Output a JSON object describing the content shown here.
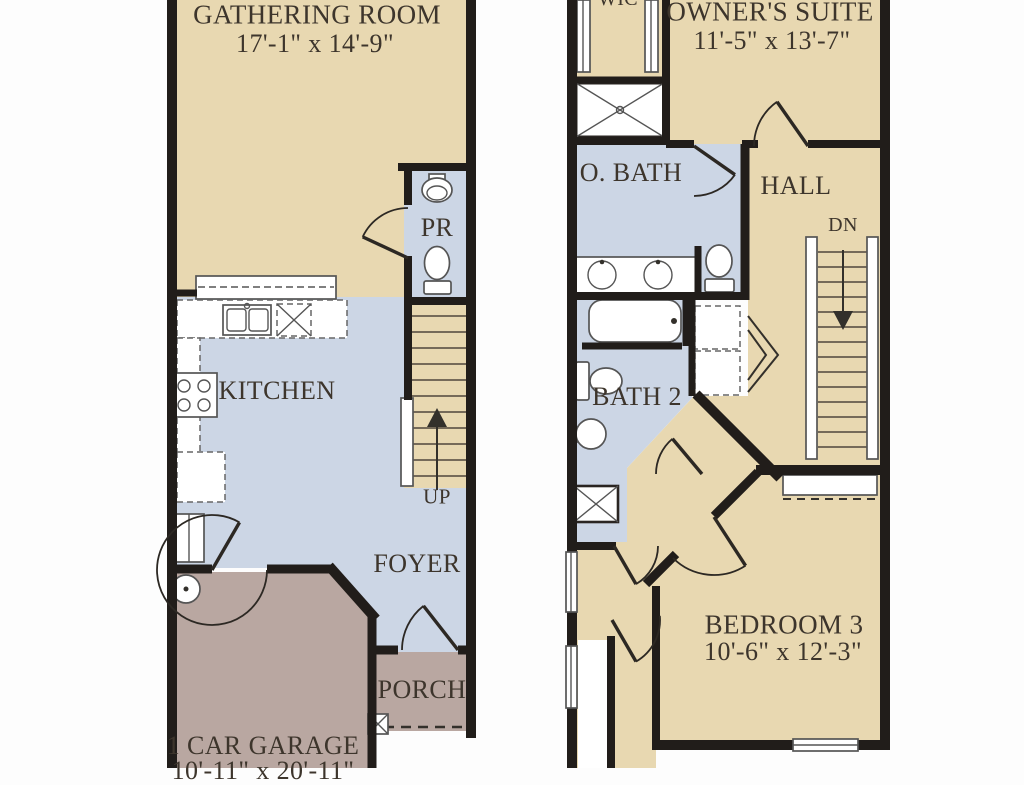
{
  "floor1": {
    "gathering": {
      "name": "GATHERING ROOM",
      "dims": "17'-1\" x 14'-9\""
    },
    "pr": {
      "name": "PR"
    },
    "kitchen": {
      "name": "KITCHEN"
    },
    "stairs": {
      "name": "UP"
    },
    "foyer": {
      "name": "FOYER"
    },
    "porch": {
      "name": "PORCH"
    },
    "garage": {
      "name": "1 CAR GARAGE",
      "dims": "10'-11\" x 20'-11\""
    }
  },
  "floor2": {
    "wic": {
      "name": "WIC"
    },
    "owners_suite": {
      "name": "OWNER'S SUITE",
      "dims": "11'-5\" x 13'-7\""
    },
    "obath": {
      "name": "O. BATH"
    },
    "hall": {
      "name": "HALL"
    },
    "stairs": {
      "name": "DN"
    },
    "bath2": {
      "name": "BATH 2"
    },
    "bedroom3": {
      "name": "BEDROOM 3",
      "dims": "10'-6\" x 12'-3\""
    }
  },
  "colors": {
    "floor_tan": "#e8d8b1",
    "floor_blue": "#ccd6e5",
    "floor_mauve": "#b9a7a1",
    "wall": "#211d1a",
    "text": "#3d352c"
  }
}
